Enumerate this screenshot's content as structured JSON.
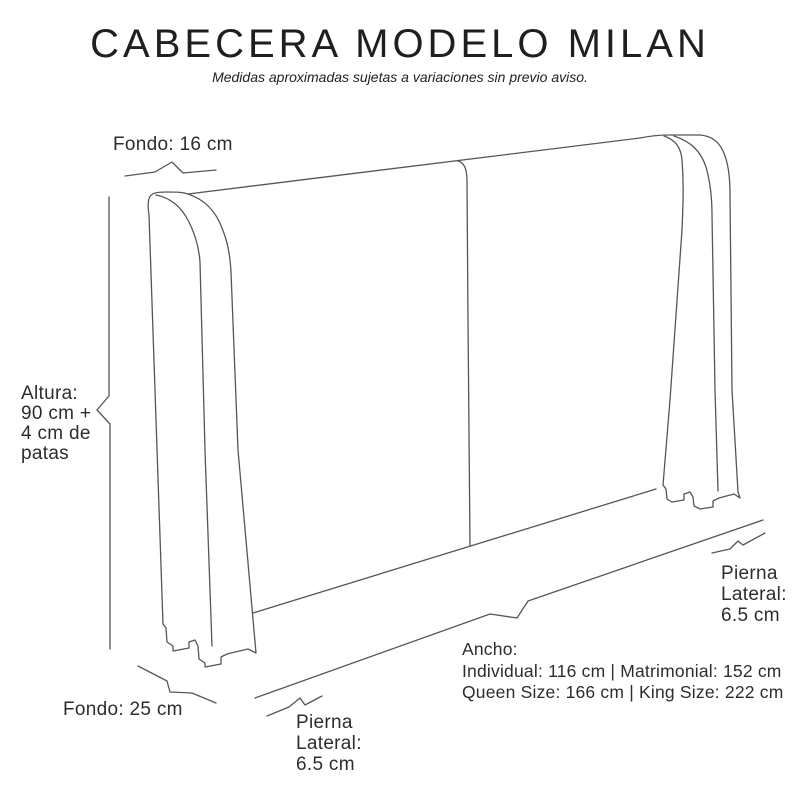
{
  "header": {
    "title": "CABECERA MODELO MILAN",
    "subtitle": "Medidas aproximadas sujetas a variaciones sin previo aviso."
  },
  "labels": {
    "fondo_top": "Fondo: 16 cm",
    "altura": "Altura:\n90 cm +\n4 cm de\npatas",
    "fondo_bottom": "Fondo: 25 cm",
    "pierna_lateral_bottom": "Pierna\nLateral:\n6.5 cm",
    "pierna_lateral_right": "Pierna\nLateral:\n6.5 cm",
    "ancho_heading": "Ancho:",
    "ancho_line1": "Individual: 116 cm | Matrimonial: 152 cm",
    "ancho_line2": "Queen Size: 166 cm | King Size: 222 cm"
  },
  "measurements": {
    "fondo_superior": "16 cm",
    "altura": "90 cm + 4 cm de patas",
    "fondo_inferior": "25 cm",
    "pierna_lateral": "6.5 cm",
    "ancho_individual": "116 cm",
    "ancho_matrimonial": "152 cm",
    "ancho_queen_size": "166 cm",
    "ancho_king_size": "222 cm"
  },
  "colors": {
    "background": "#ffffff",
    "text": "#2d2d2d",
    "line": "#54565a"
  }
}
